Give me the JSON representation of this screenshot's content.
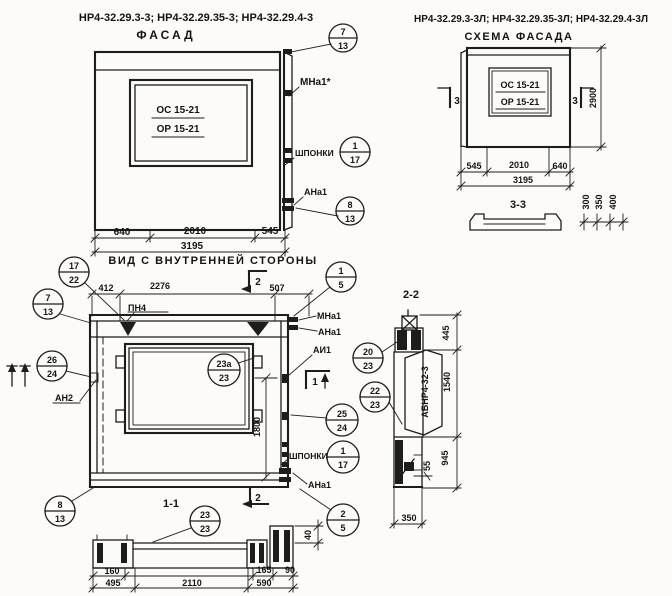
{
  "header": {
    "left_marks": "НР4-32.29.3-3; НР4-32.29.35-3; НР4-32.29.4-3",
    "left_title": "ФАСАД",
    "right_marks": "НР4-32.29.3-3Л; НР4-32.29.35-3Л; НР4-32.29.4-3Л",
    "right_title": "СХЕМА ФАСАДА"
  },
  "facade": {
    "window_mark_top": "ОС 15-21",
    "window_mark_bottom": "ОР 15-21",
    "dim_left": "640",
    "dim_mid": "2010",
    "dim_right": "545",
    "dim_total": "3195",
    "label_mna1": "МНа1*",
    "label_shponki": "ШПОНКИ",
    "label_ana1": "АНа1",
    "callout_corner": {
      "num": "7",
      "sheet": "13"
    },
    "callout_shponki": {
      "num": "1",
      "sheet": "17"
    },
    "callout_anchor": {
      "num": "8",
      "sheet": "13"
    }
  },
  "scheme": {
    "window_mark_top": "ОС 15-21",
    "window_mark_bottom": "ОР 15-21",
    "section_mark_left": "3",
    "section_mark_right": "3",
    "dim_height": "2900",
    "dim_left": "545",
    "dim_mid": "2010",
    "dim_right": "640",
    "dim_total": "3195"
  },
  "section33": {
    "title": "3-3",
    "dims": [
      "300",
      "350",
      "400"
    ]
  },
  "plan": {
    "title": "ВИД С ВНУТРЕННЕЙ СТОРОНЫ",
    "dim_left": "412",
    "dim_mid": "2276",
    "dim_right": "507",
    "dim_window_height": "1800",
    "label_pn4": "ПН4",
    "label_mna1": "МНа1",
    "label_ana1_top": "АНа1",
    "label_ai1": "АИ1",
    "label_an2": "АН2",
    "label_shponki": "ШПОНКИ",
    "label_ana1_bottom": "АНа1",
    "section_mark_2": "2",
    "section_mark_1": "1",
    "callout_17_22": {
      "num": "17",
      "sheet": "22"
    },
    "callout_1_5": {
      "num": "1",
      "sheet": "5"
    },
    "callout_7_13": {
      "num": "7",
      "sheet": "13"
    },
    "callout_26_24": {
      "num": "26",
      "sheet": "24"
    },
    "callout_23a_23": {
      "num": "23а",
      "sheet": "23"
    },
    "callout_20_23": {
      "num": "20",
      "sheet": "23"
    },
    "callout_22_23": {
      "num": "22",
      "sheet": "23"
    },
    "callout_25_24": {
      "num": "25",
      "sheet": "24"
    },
    "callout_1_17": {
      "num": "1",
      "sheet": "17"
    },
    "callout_8_13": {
      "num": "8",
      "sheet": "13"
    },
    "callout_2_5": {
      "num": "2",
      "sheet": "5"
    }
  },
  "section11": {
    "title": "1-1",
    "section_mark_2": "2",
    "callout_23_23": {
      "num": "23",
      "sheet": "23"
    },
    "dim_thickness": "40",
    "dim_160": "160",
    "dim_165": "165",
    "dim_90": "90",
    "dim_495": "495",
    "dim_2110": "2110",
    "dim_590": "590"
  },
  "section22": {
    "title": "2-2",
    "panel_mark": "АБНР4-32-3",
    "dim_445": "445",
    "dim_1540": "1540",
    "dim_55": "55",
    "dim_945": "945",
    "dim_350": "350"
  }
}
